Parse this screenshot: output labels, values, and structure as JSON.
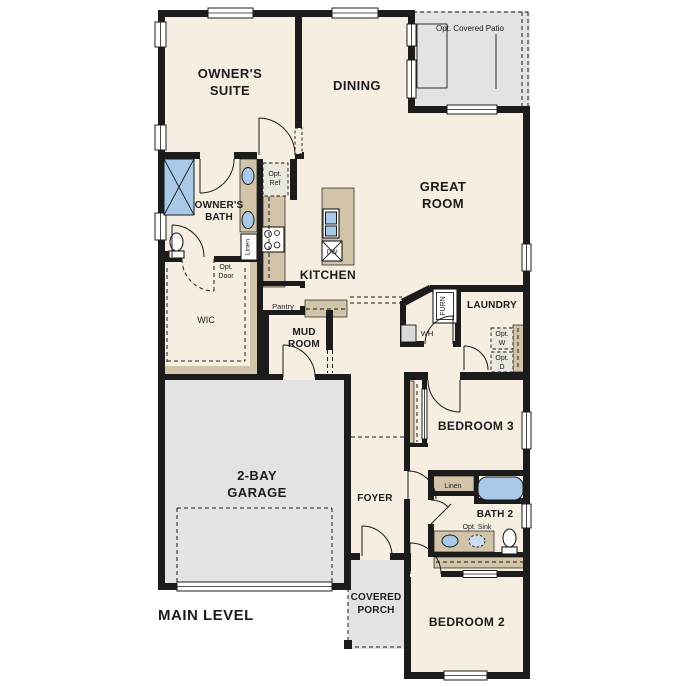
{
  "title": "MAIN LEVEL",
  "colors": {
    "wall": "#1c1c1c",
    "floor": "#f5eee1",
    "tan": "#d1c4a9",
    "gray": "#e3e3e3",
    "blue": "#a9c9e9",
    "optbox": "#eae7de",
    "appliance": "#d9d9d9"
  },
  "rooms": {
    "owners_suite": {
      "lines": [
        "OWNER'S",
        "SUITE"
      ]
    },
    "dining": {
      "label": "DINING"
    },
    "great_room": {
      "lines": [
        "GREAT",
        "ROOM"
      ]
    },
    "owners_bath": {
      "lines": [
        "OWNER'S",
        "BATH"
      ]
    },
    "kitchen": {
      "label": "KITCHEN"
    },
    "wic": {
      "label": "WIC"
    },
    "pantry": {
      "label": "Pantry"
    },
    "mud_room": {
      "lines": [
        "MUD",
        "ROOM"
      ]
    },
    "laundry": {
      "label": "LAUNDRY"
    },
    "bedroom_3": {
      "label": "BEDROOM 3"
    },
    "garage": {
      "lines": [
        "2-BAY",
        "GARAGE"
      ]
    },
    "foyer": {
      "label": "FOYER"
    },
    "bath_2": {
      "label": "BATH 2"
    },
    "bedroom_2": {
      "label": "BEDROOM 2"
    },
    "covered_porch": {
      "lines": [
        "COVERED",
        "PORCH"
      ]
    }
  },
  "annotations": {
    "opt_covered_patio": "Opt. Covered Patio",
    "opt_ref": {
      "lines": [
        "Opt.",
        "Ref"
      ]
    },
    "opt_door": {
      "lines": [
        "Opt.",
        "Door"
      ]
    },
    "opt_w": {
      "lines": [
        "Opt.",
        "W"
      ]
    },
    "opt_d": {
      "lines": [
        "Opt.",
        "D"
      ]
    },
    "opt_sink": "Opt. Sink",
    "linen_owners": "Linen",
    "linen_hall": "Linen",
    "furnace": "FURN",
    "water_heater": "WH",
    "dishwasher": "DW"
  }
}
